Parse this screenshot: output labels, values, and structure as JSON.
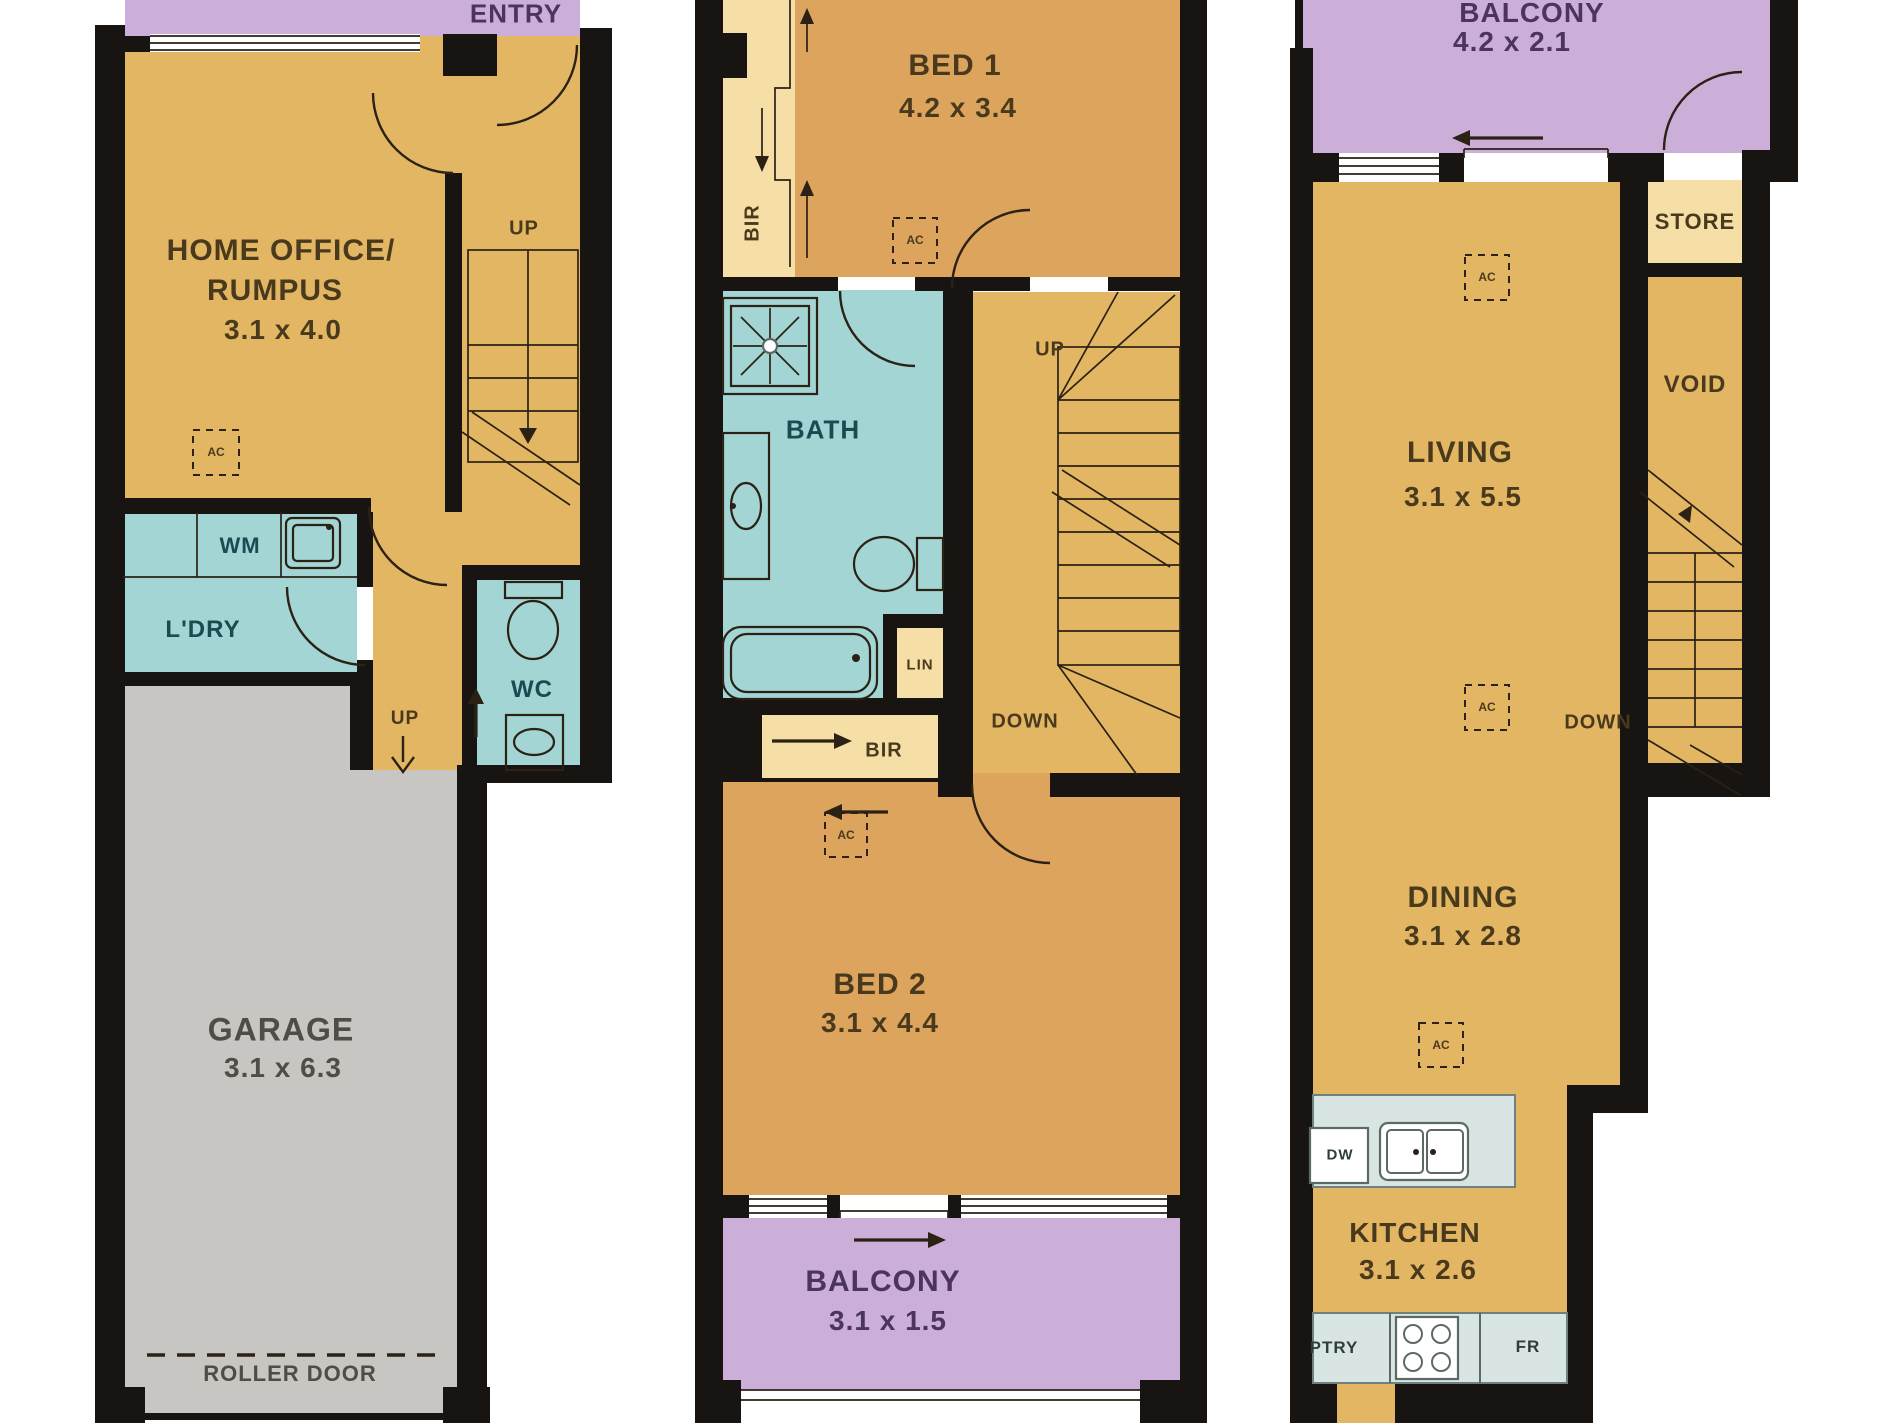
{
  "colors": {
    "wall": "#181411",
    "line": "#2b2114",
    "gold": "#e3b663",
    "orange": "#dca45d",
    "teal": "#a2d5d3",
    "purple": "#cbafd9",
    "cream": "#f6dfa6",
    "gray": "#c8c6c3",
    "bench": "#d9e5e3",
    "text_gold": "#4a3a1d",
    "text_teal": "#1d4a52",
    "text_purple": "#4b3560",
    "text_gray": "#514c45",
    "text_bench": "#2f3e3c"
  },
  "floors": {
    "ground": {
      "rooms": [
        {
          "name": "ENTRY"
        },
        {
          "name": "HOME OFFICE/RUMPUS",
          "dimensions": "3.1 x 4.0"
        },
        {
          "name": "L'DRY"
        },
        {
          "name": "WC"
        },
        {
          "name": "GARAGE",
          "dimensions": "3.1 x 6.3"
        }
      ],
      "features": [
        "UP",
        "WM",
        "AC",
        "ROLLER DOOR"
      ]
    },
    "first": {
      "rooms": [
        {
          "name": "BED 1",
          "dimensions": "4.2 x 3.4"
        },
        {
          "name": "BATH"
        },
        {
          "name": "BED 2",
          "dimensions": "3.1 x 4.4"
        },
        {
          "name": "BALCONY",
          "dimensions": "3.1 x 1.5"
        }
      ],
      "features": [
        "BIR",
        "LIN",
        "UP",
        "DOWN",
        "AC"
      ]
    },
    "second": {
      "rooms": [
        {
          "name": "BALCONY",
          "dimensions": "4.2 x 2.1"
        },
        {
          "name": "STORE"
        },
        {
          "name": "VOID"
        },
        {
          "name": "LIVING",
          "dimensions": "3.1 x 5.5"
        },
        {
          "name": "DINING",
          "dimensions": "3.1 x 2.8"
        },
        {
          "name": "KITCHEN",
          "dimensions": "3.1 x 2.6"
        }
      ],
      "features": [
        "DOWN",
        "AC",
        "DW",
        "PTRY",
        "FR"
      ]
    }
  },
  "labels": {
    "entry": "ENTRY",
    "up": "UP",
    "down": "DOWN",
    "home_office_1": "HOME OFFICE/",
    "home_office_2": "RUMPUS",
    "home_office_dim": "3.1 x 4.0",
    "ac": "AC",
    "wm": "WM",
    "ldry": "L'DRY",
    "wc": "WC",
    "garage": "GARAGE",
    "garage_dim": "3.1 x 6.3",
    "roller_door": "ROLLER DOOR",
    "bed1": "BED 1",
    "bed1_dim": "4.2 x 3.4",
    "bir": "BIR",
    "bath": "BATH",
    "lin": "LIN",
    "bed2": "BED 2",
    "bed2_dim": "3.1 x 4.4",
    "balcony": "BALCONY",
    "balcony1_dim": "3.1 x 1.5",
    "balcony2_dim": "4.2 x 2.1",
    "store": "STORE",
    "void_label": "VOID",
    "living": "LIVING",
    "living_dim": "3.1 x 5.5",
    "dining": "DINING",
    "dining_dim": "3.1 x 2.8",
    "kitchen": "KITCHEN",
    "kitchen_dim": "3.1 x 2.6",
    "dw": "DW",
    "ptry": "PTRY",
    "fr": "FR"
  }
}
